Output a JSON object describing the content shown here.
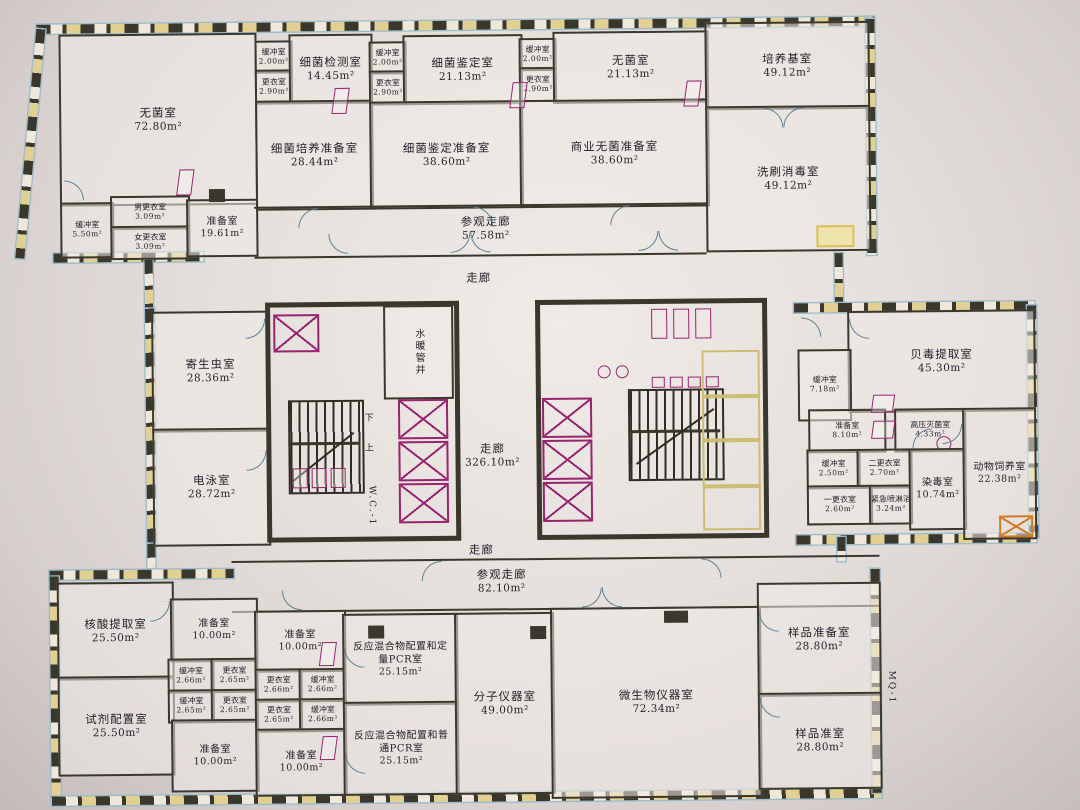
{
  "corridors": {
    "view_top": {
      "n": "参观走廊",
      "a": "57.58m²"
    },
    "hall_top": {
      "n": "走廊"
    },
    "hall_main": {
      "n": "走廊",
      "a": "326.10m²"
    },
    "hall_bottom": {
      "n": "走廊"
    },
    "view_bottom": {
      "n": "参观走廊",
      "a": "82.10m²"
    }
  },
  "labels": {
    "shaft": "水暖管井",
    "wc": "W.C.-1",
    "up": "上",
    "down": "下",
    "ref": "MQ-1"
  },
  "rooms": [
    {
      "n": "无菌室",
      "a": "72.80m²"
    },
    {
      "n": "缓冲室",
      "a": "2.00m²"
    },
    {
      "n": "更衣室",
      "a": "2.90m²"
    },
    {
      "n": "细菌检测室",
      "a": "14.45m²"
    },
    {
      "n": "细菌培养准备室",
      "a": "28.44m²"
    },
    {
      "n": "缓冲室",
      "a": "2.00m²"
    },
    {
      "n": "更衣室",
      "a": "2.90m²"
    },
    {
      "n": "细菌鉴定室",
      "a": "21.13m²"
    },
    {
      "n": "细菌鉴定准备室",
      "a": "38.60m²"
    },
    {
      "n": "缓冲室",
      "a": "2.00m²"
    },
    {
      "n": "更衣室",
      "a": "2.90m²"
    },
    {
      "n": "无菌室",
      "a": "21.13m²"
    },
    {
      "n": "商业无菌准备室",
      "a": "38.60m²"
    },
    {
      "n": "培养基室",
      "a": "49.12m²"
    },
    {
      "n": "洗刷消毒室",
      "a": "49.12m²"
    },
    {
      "n": "缓冲室",
      "a": "5.50m²"
    },
    {
      "n": "男更衣室",
      "a": "3.09m²"
    },
    {
      "n": "女更衣室",
      "a": "3.09m²"
    },
    {
      "n": "准备室",
      "a": "19.61m²"
    },
    {
      "n": "寄生虫室",
      "a": "28.36m²"
    },
    {
      "n": "电泳室",
      "a": "28.72m²"
    },
    {
      "n": "贝毒提取室",
      "a": "45.30m²"
    },
    {
      "n": "缓冲室",
      "a": "7.18m²"
    },
    {
      "n": "准备室",
      "a": "8.10m²"
    },
    {
      "n": "高压灭菌室",
      "a": "4.33m²"
    },
    {
      "n": "缓冲室",
      "a": "2.50m²"
    },
    {
      "n": "二更衣室",
      "a": "2.70m²"
    },
    {
      "n": "一更衣室",
      "a": "2.60m²"
    },
    {
      "n": "紧急喷淋浴",
      "a": "3.24m²"
    },
    {
      "n": "染毒室",
      "a": "10.74m²"
    },
    {
      "n": "动物饲养室",
      "a": "22.38m²"
    },
    {
      "n": "核酸提取室",
      "a": "25.50m²"
    },
    {
      "n": "试剂配置室",
      "a": "25.50m²"
    },
    {
      "n": "准备室",
      "a": "10.00m²"
    },
    {
      "n": "缓冲室",
      "a": "2.66m²"
    },
    {
      "n": "更衣室",
      "a": "2.65m²"
    },
    {
      "n": "缓冲室",
      "a": "2.65m²"
    },
    {
      "n": "更衣室",
      "a": "2.65m²"
    },
    {
      "n": "准备室",
      "a": "10.00m²"
    },
    {
      "n": "准备室",
      "a": "10.00m²"
    },
    {
      "n": "更衣室",
      "a": "2.66m²"
    },
    {
      "n": "缓冲室",
      "a": "2.66m²"
    },
    {
      "n": "更衣室",
      "a": "2.65m²"
    },
    {
      "n": "缓冲室",
      "a": "2.66m²"
    },
    {
      "n": "准备室",
      "a": "10.00m²"
    },
    {
      "n": "反应混合物配置和定量PCR室",
      "a": "25.15m²"
    },
    {
      "n": "反应混合物配置和普通PCR室",
      "a": "25.15m²"
    },
    {
      "n": "分子仪器室",
      "a": "49.00m²"
    },
    {
      "n": "微生物仪器室",
      "a": "72.34m²"
    },
    {
      "n": "样品准备室",
      "a": "28.80m²"
    },
    {
      "n": "样品准室",
      "a": "28.80m²"
    }
  ]
}
